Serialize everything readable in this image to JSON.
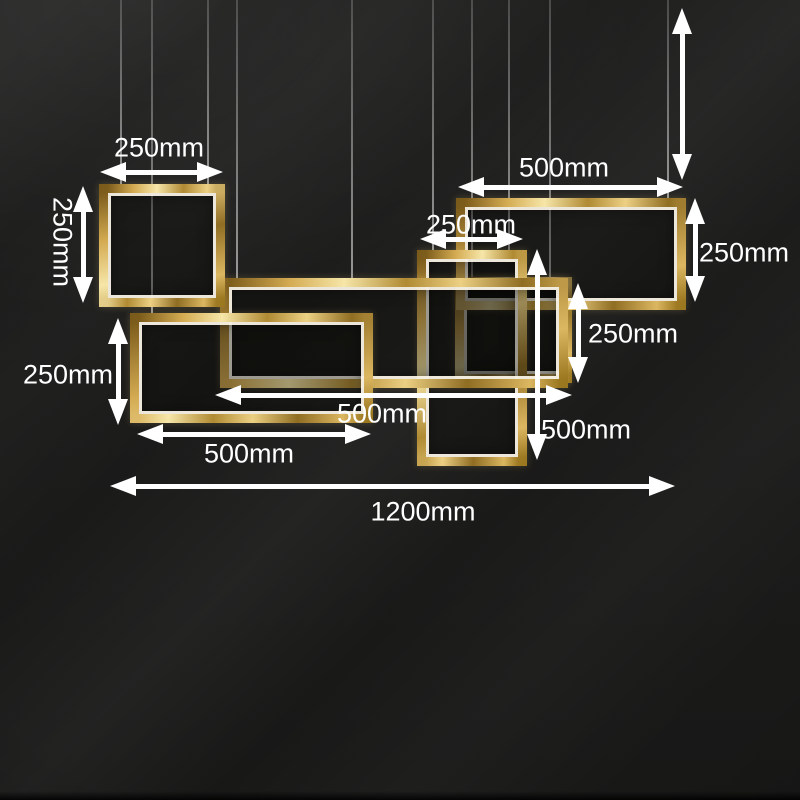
{
  "colors": {
    "background": "#1d1d1c",
    "frame_gold": "#c9a24a",
    "frame_gold_light": "#f6e6a8",
    "frame_gold_dark": "#7a5a1a",
    "led_white": "#fffaeb",
    "annotation_white": "#ffffff",
    "wire_gray": "#aaaaaa"
  },
  "scene": {
    "wires": [
      {
        "x": 121,
        "to_y": 185
      },
      {
        "x": 152,
        "to_y": 313
      },
      {
        "x": 208,
        "to_y": 185
      },
      {
        "x": 237,
        "to_y": 278
      },
      {
        "x": 352,
        "to_y": 278
      },
      {
        "x": 433,
        "to_y": 250
      },
      {
        "x": 472,
        "to_y": 277
      },
      {
        "x": 509,
        "to_y": 250
      },
      {
        "x": 550,
        "to_y": 277
      },
      {
        "x": 668,
        "to_y": 200
      }
    ],
    "frames": [
      {
        "name": "right-middle-square-frame",
        "x": 455,
        "y": 277,
        "w": 117,
        "h": 106
      },
      {
        "name": "top-right-rect-frame",
        "x": 456,
        "y": 198,
        "w": 230,
        "h": 112
      },
      {
        "name": "middle-tall-rect-frame",
        "x": 417,
        "y": 250,
        "w": 110,
        "h": 216
      },
      {
        "name": "center-wide-rect-frame",
        "x": 220,
        "y": 278,
        "w": 348,
        "h": 110
      },
      {
        "name": "lower-left-rect-frame",
        "x": 130,
        "y": 313,
        "w": 243,
        "h": 110
      },
      {
        "name": "top-left-square-frame",
        "x": 99,
        "y": 184,
        "w": 126,
        "h": 123
      }
    ],
    "dimension_arrows": [
      {
        "orient": "h",
        "x1": 100,
        "x2": 223,
        "y": 172
      },
      {
        "orient": "v",
        "x": 83,
        "y1": 186,
        "y2": 303
      },
      {
        "orient": "v",
        "x": 118,
        "y1": 318,
        "y2": 425
      },
      {
        "orient": "h",
        "x1": 458,
        "x2": 683,
        "y": 187
      },
      {
        "orient": "v",
        "x": 682,
        "y1": 8,
        "y2": 180
      },
      {
        "orient": "h",
        "x1": 420,
        "x2": 523,
        "y": 239
      },
      {
        "orient": "v",
        "x": 695,
        "y1": 198,
        "y2": 302
      },
      {
        "orient": "v",
        "x": 578,
        "y1": 283,
        "y2": 383
      },
      {
        "orient": "v",
        "x": 537,
        "y1": 249,
        "y2": 460
      },
      {
        "orient": "h",
        "x1": 215,
        "x2": 572,
        "y": 395
      },
      {
        "orient": "h",
        "x1": 137,
        "x2": 371,
        "y": 434
      },
      {
        "orient": "h",
        "x1": 110,
        "x2": 675,
        "y": 486
      }
    ],
    "dimension_labels": [
      {
        "text": "250mm",
        "x": 159,
        "y": 148,
        "rotate": 0
      },
      {
        "text": "250mm",
        "x": 62,
        "y": 242,
        "rotate": 90
      },
      {
        "text": "250mm",
        "x": 68,
        "y": 375,
        "rotate": 0
      },
      {
        "text": "500mm",
        "x": 564,
        "y": 168,
        "rotate": 0
      },
      {
        "text": "250mm",
        "x": 471,
        "y": 225,
        "rotate": 0
      },
      {
        "text": "250mm",
        "x": 744,
        "y": 253,
        "rotate": 0
      },
      {
        "text": "250mm",
        "x": 633,
        "y": 334,
        "rotate": 0
      },
      {
        "text": "500mm",
        "x": 586,
        "y": 430,
        "rotate": 0
      },
      {
        "text": "500mm",
        "x": 382,
        "y": 414,
        "rotate": 0
      },
      {
        "text": "500mm",
        "x": 249,
        "y": 454,
        "rotate": 0
      },
      {
        "text": "1200mm",
        "x": 423,
        "y": 512,
        "rotate": 0
      }
    ]
  }
}
